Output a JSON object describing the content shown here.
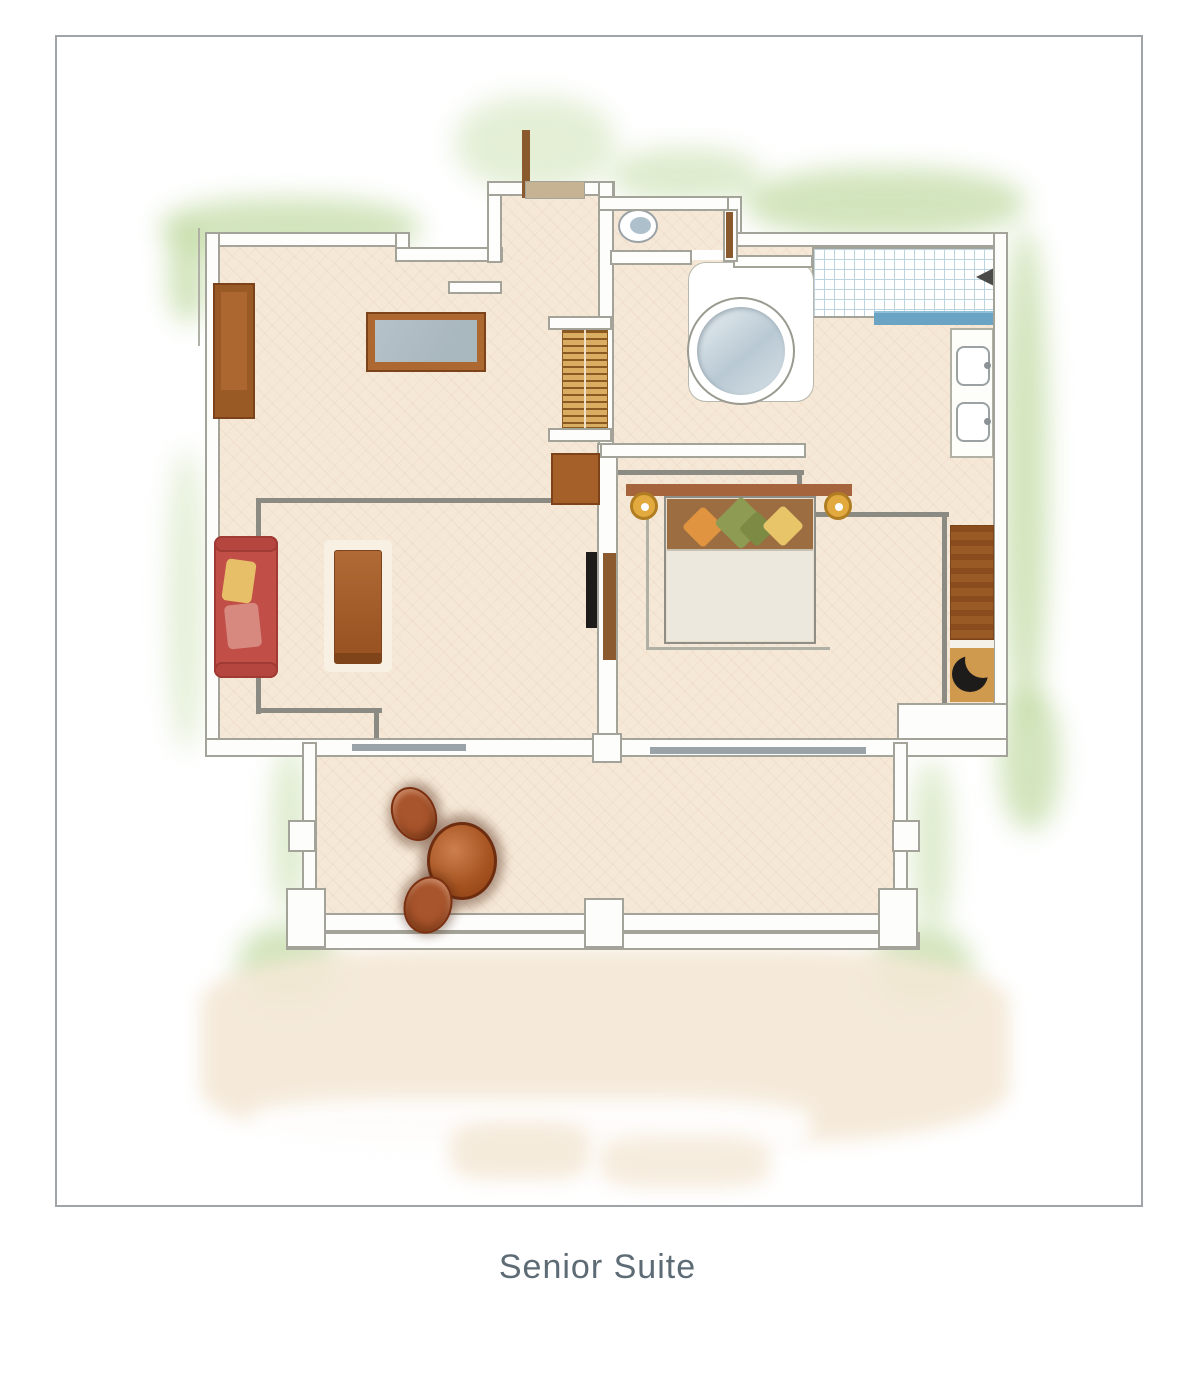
{
  "figure": {
    "caption": "Senior Suite",
    "type": "floor-plan"
  },
  "palette": {
    "frame_border": "#9fa4a8",
    "caption_color": "#5d6b75",
    "floor": "#f6e8d7",
    "wall_fill": "#fdfdfb",
    "wall_edge": "#a3a399",
    "line": "#8b8b83",
    "glow_green": "#aecf86",
    "wash_cream": "#f4e8d6",
    "wood_mid": "#ad6832",
    "wood_dark": "#9a5a26",
    "wood_light": "#d9ad62",
    "sofa_red": "#c14f48",
    "table_top_gray": "#a9b7bf",
    "tub_blue": "#b9c9d3",
    "glass_blue": "#6ba3c4",
    "tile_line": "#bcd3e0",
    "gold": "#e2a93e",
    "pillow_orange": "#e09440",
    "pillow_green": "#8e9b52",
    "pillow_yellow": "#e9c56a",
    "linen": "#ece8de",
    "headboard_brown": "#9b6d41",
    "terracotta": "#a8542c",
    "niche_floor": "#cf9a4e",
    "black_item": "#1e1c1a"
  }
}
